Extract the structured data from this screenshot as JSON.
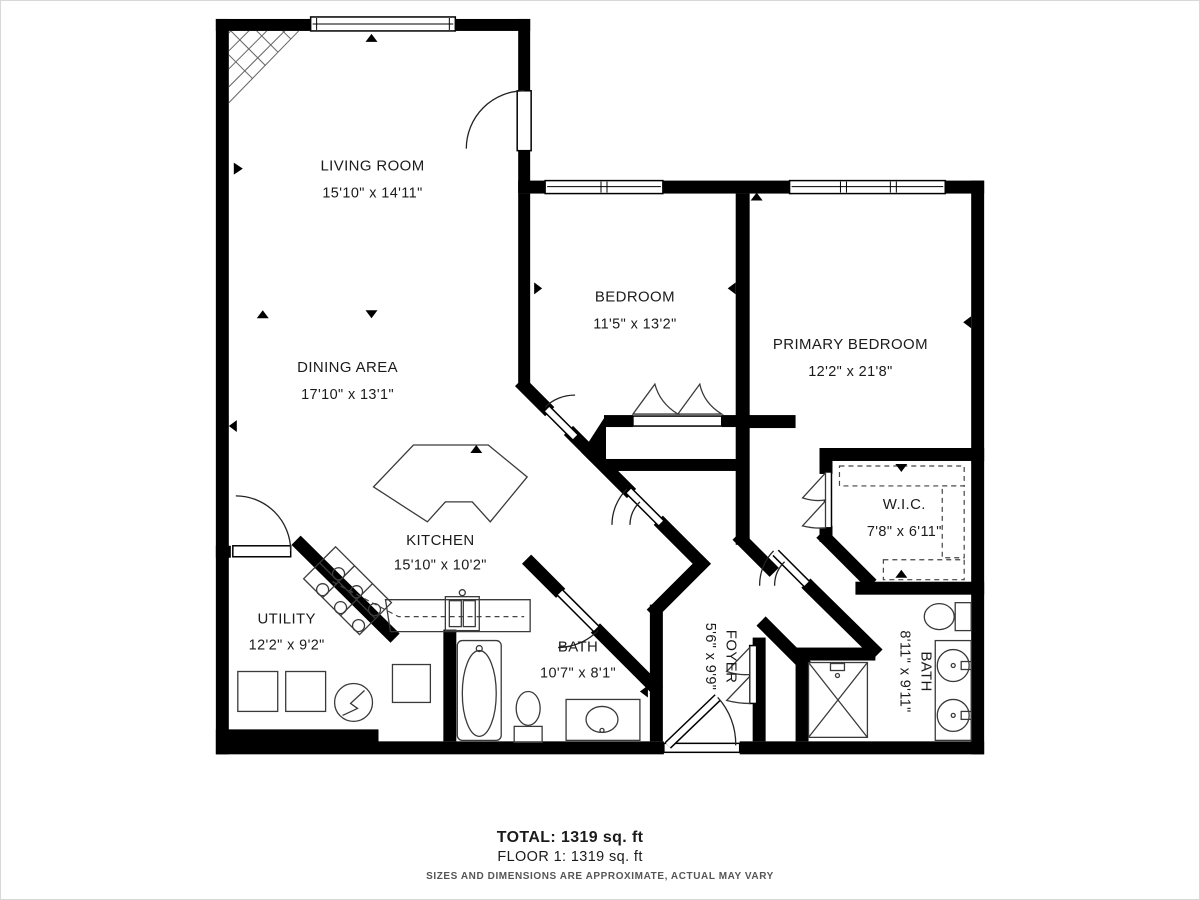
{
  "plan": {
    "rooms": [
      {
        "id": "living-room",
        "name": "LIVING ROOM",
        "dims": "15'10\" x 14'11\""
      },
      {
        "id": "dining-area",
        "name": "DINING AREA",
        "dims": "17'10\" x 13'1\""
      },
      {
        "id": "bedroom",
        "name": "BEDROOM",
        "dims": "11'5\" x 13'2\""
      },
      {
        "id": "primary-bedroom",
        "name": "PRIMARY BEDROOM",
        "dims": "12'2\" x 21'8\""
      },
      {
        "id": "kitchen",
        "name": "KITCHEN",
        "dims": "15'10\" x 10'2\""
      },
      {
        "id": "utility",
        "name": "UTILITY",
        "dims": "12'2\" x 9'2\""
      },
      {
        "id": "bath",
        "name": "BATH",
        "dims": "10'7\" x 8'1\""
      },
      {
        "id": "wic",
        "name": "W.I.C.",
        "dims": "7'8\" x 6'11\""
      },
      {
        "id": "foyer",
        "name": "FOYER",
        "dims": "5'6\" x 9'9\""
      },
      {
        "id": "primary-bath",
        "name": "BATH",
        "dims": "8'11\" x 9'11\""
      }
    ],
    "footer": {
      "total": "TOTAL: 1319 sq. ft",
      "floor": "FLOOR 1: 1319 sq. ft",
      "disclaimer": "SIZES AND DIMENSIONS ARE APPROXIMATE, ACTUAL MAY VARY"
    },
    "colors": {
      "wall": "#000000",
      "fixture_stroke": "#3a3a3a",
      "text": "#1b1b1b",
      "disclaimer_text": "#555555"
    }
  }
}
